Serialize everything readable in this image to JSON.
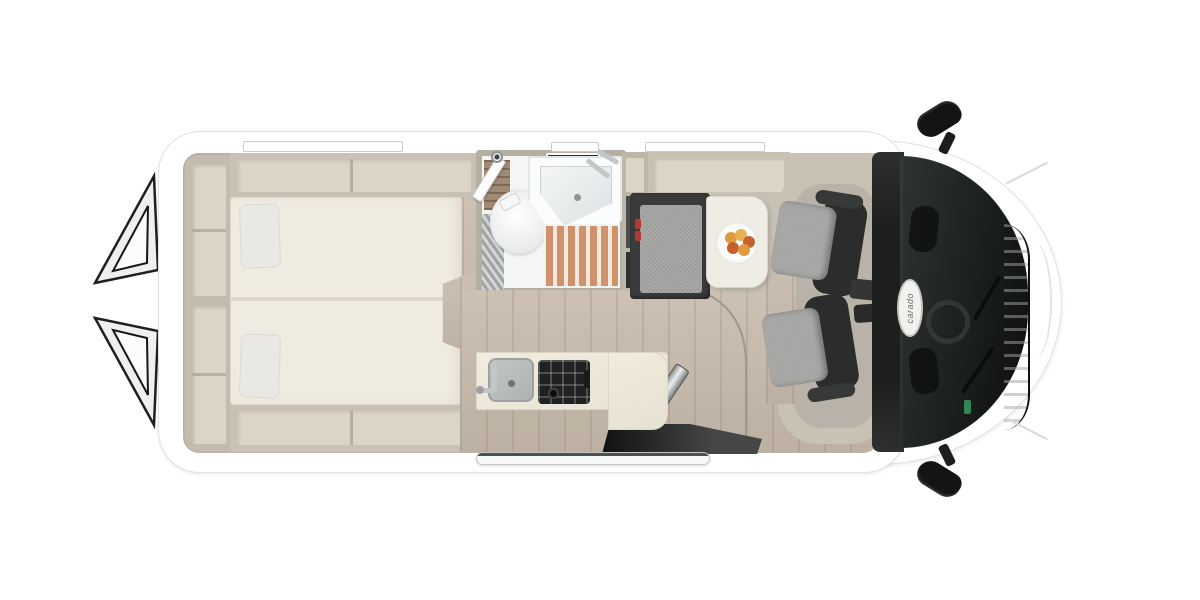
{
  "badge": {
    "text": "carado"
  },
  "colors": {
    "bg": "#ffffff",
    "body-edge": "#dfe2e2",
    "wall": "#c8c2b5",
    "wall-dark": "#b5afa2",
    "shelf-inner": "#dcd5c6",
    "mattress": "#f0ebe1",
    "mattress-edge": "#ddd7ca",
    "pillow": "#e9e8e4",
    "wood": "#c7baab",
    "wood-seam": "#a2968a",
    "bath-floor": "#f4f5f5",
    "teak": "#d0916b",
    "bench-frame": "#3a3b3b",
    "fabric": "#a4a4a2",
    "seat-frame": "#2b2d2c",
    "table-top": "#efece3",
    "hob-dark": "#202121",
    "steel": "#c3c7c7",
    "buckle-red": "#b23b31",
    "fruit-a": "#e19a3f",
    "fruit-b": "#c4622f",
    "fruit-c": "#e7b053",
    "mirror-black": "#131514",
    "badge-face": "#f1f1ee",
    "badge-text": "#6f6f6a",
    "vent-dark": "#2d2f2e",
    "sticker-green": "#37915d"
  }
}
